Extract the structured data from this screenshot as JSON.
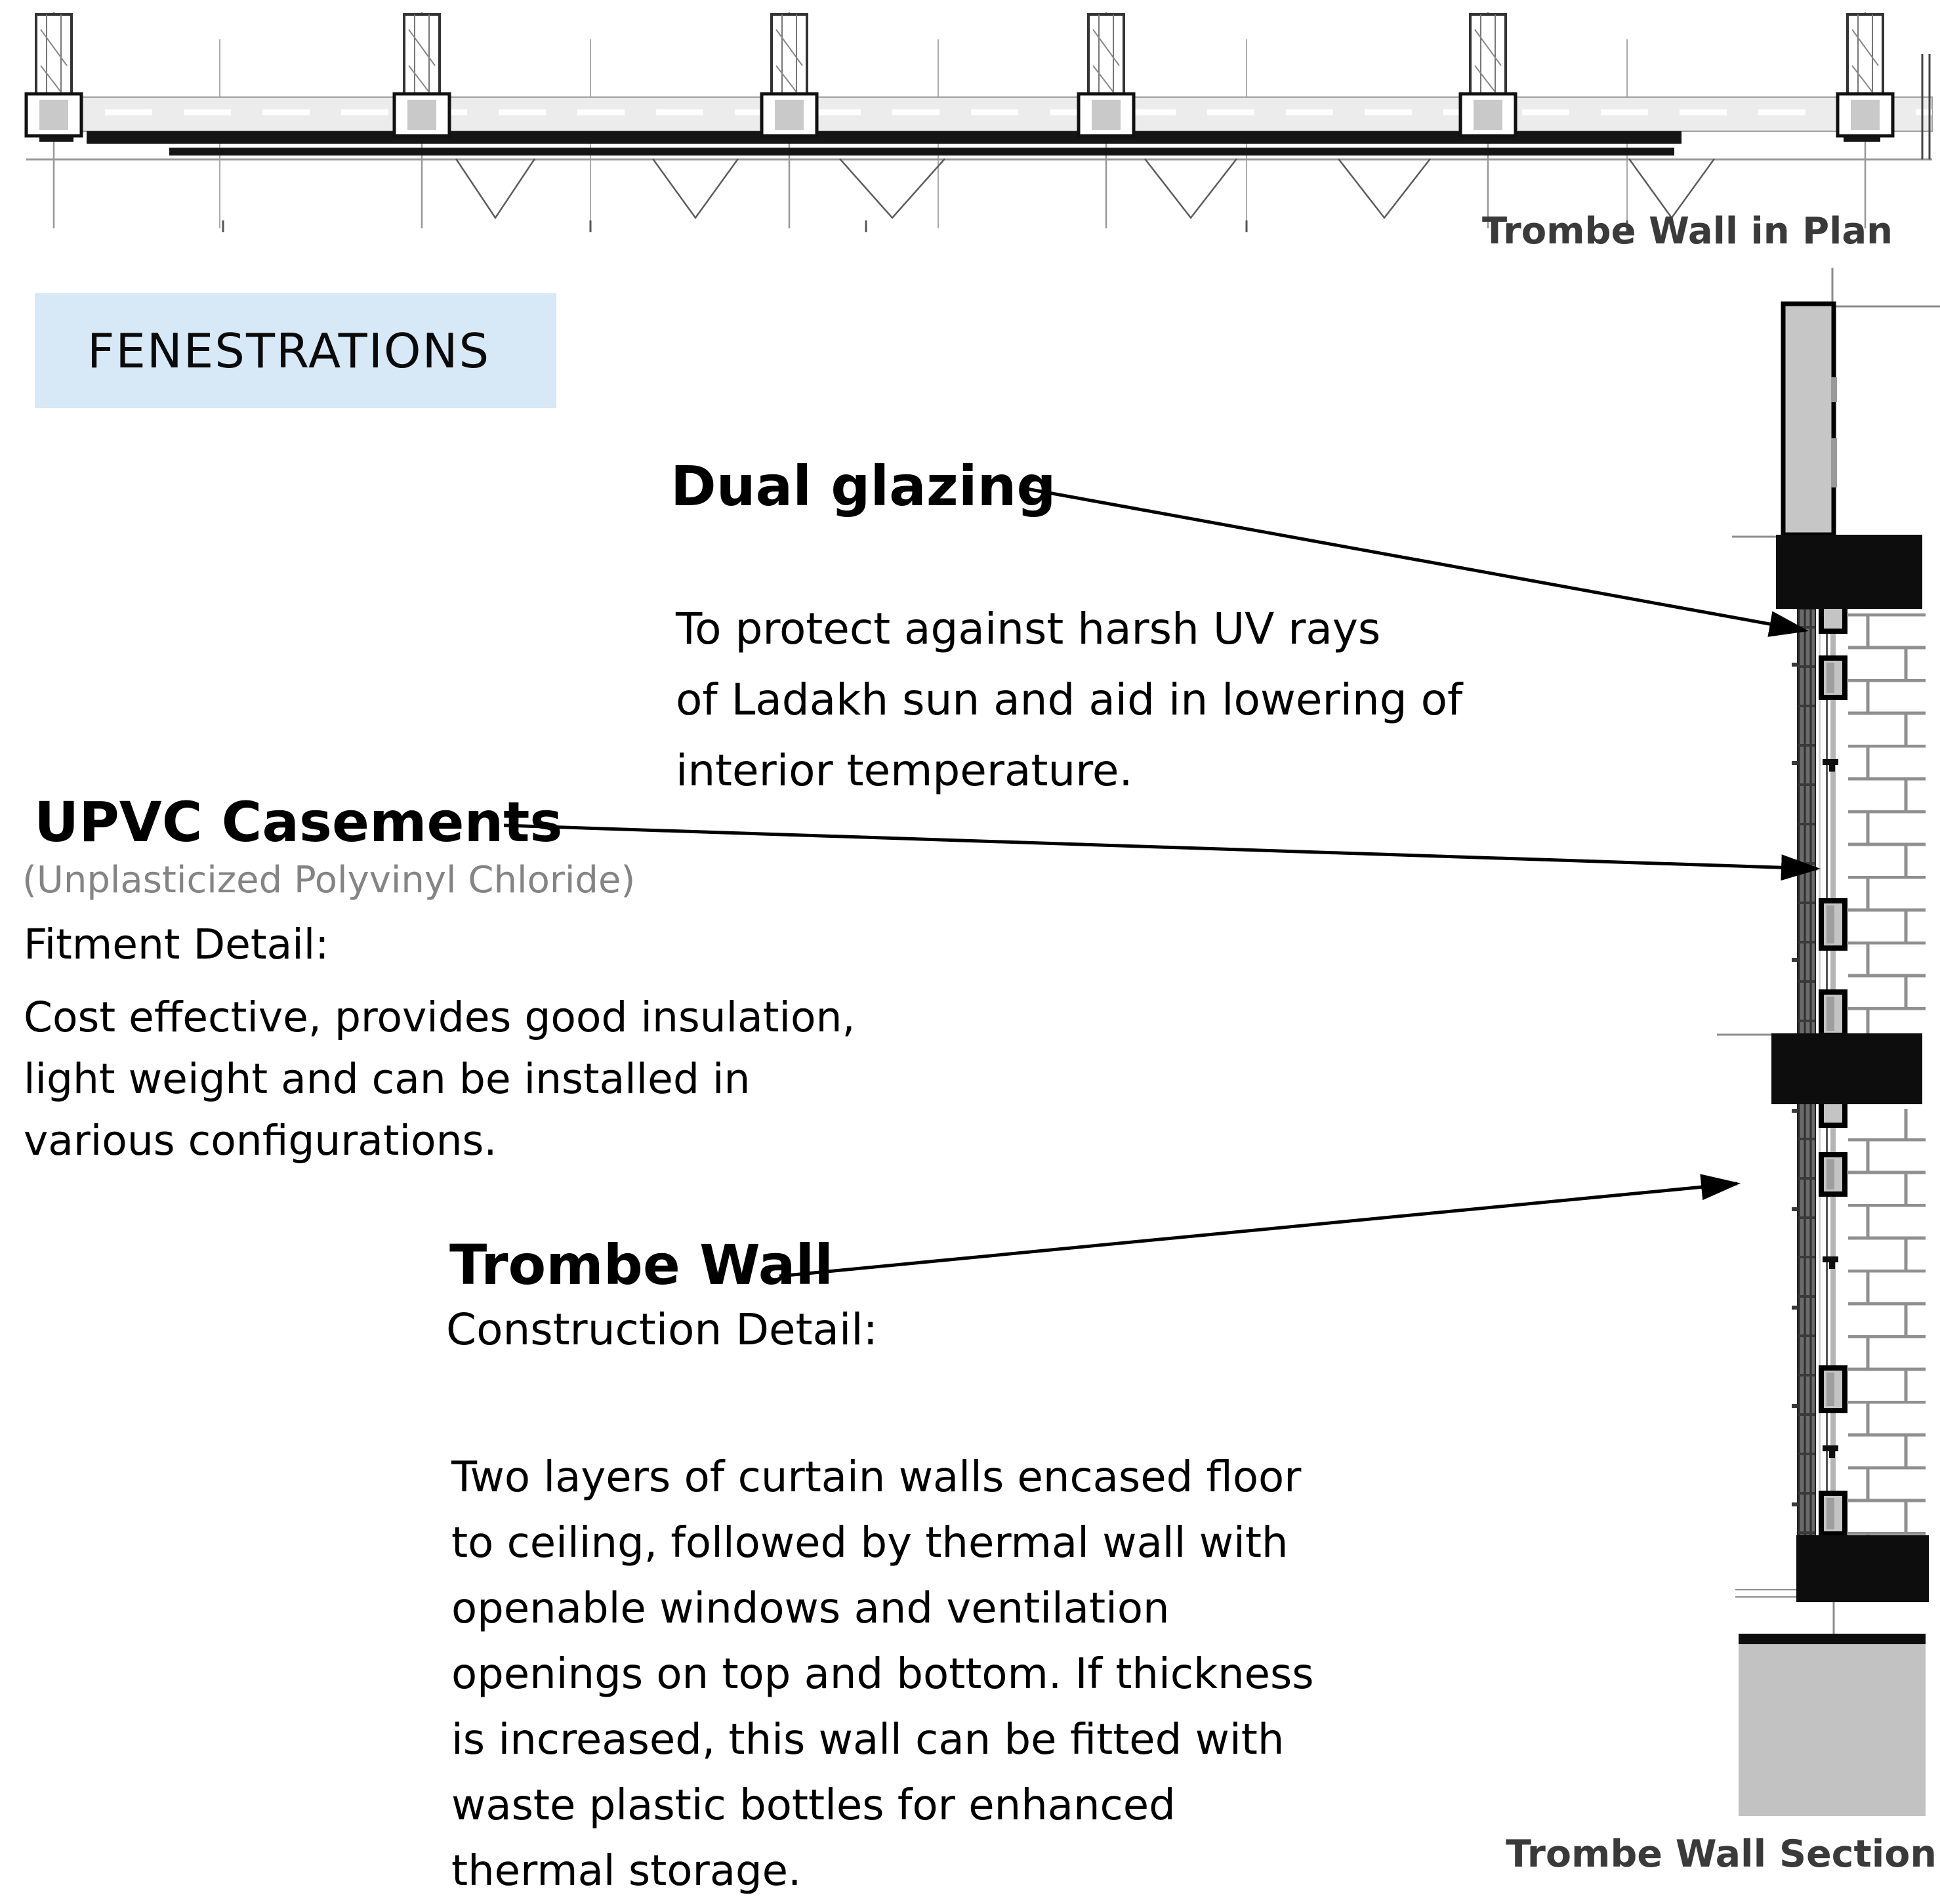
{
  "page": {
    "title": "FENESTRATIONS"
  },
  "plan": {
    "caption": "Trombe Wall in Plan"
  },
  "section": {
    "caption": "Trombe Wall Section"
  },
  "annotations": {
    "dual_glazing": {
      "heading": "Dual glazing",
      "body": "To protect against harsh UV rays\nof Ladakh sun and aid in lowering of\ninterior temperature."
    },
    "upvc": {
      "heading": "UPVC Casements",
      "subheading": "(Unplasticized Polyvinyl Chloride)",
      "label": "Fitment Detail:",
      "body": "Cost effective, provides good insulation,\nlight weight and can be installed in\nvarious configurations."
    },
    "trombe": {
      "heading": "Trombe Wall",
      "label": "Construction Detail:",
      "body": "Two layers of curtain walls encased floor\nto ceiling, followed by thermal wall with\nopenable windows and ventilation\nopenings on top and bottom. If thickness\nis increased, this wall can be fitted with\nwaste plastic bottles for enhanced\nthermal storage."
    }
  },
  "colors": {
    "highlight_box": "#d7e8f7",
    "caption_text": "#3a3a3a",
    "muted_text": "#848484",
    "slab_black": "#0d0d0d",
    "concrete_gray": "#c6c6c6"
  }
}
